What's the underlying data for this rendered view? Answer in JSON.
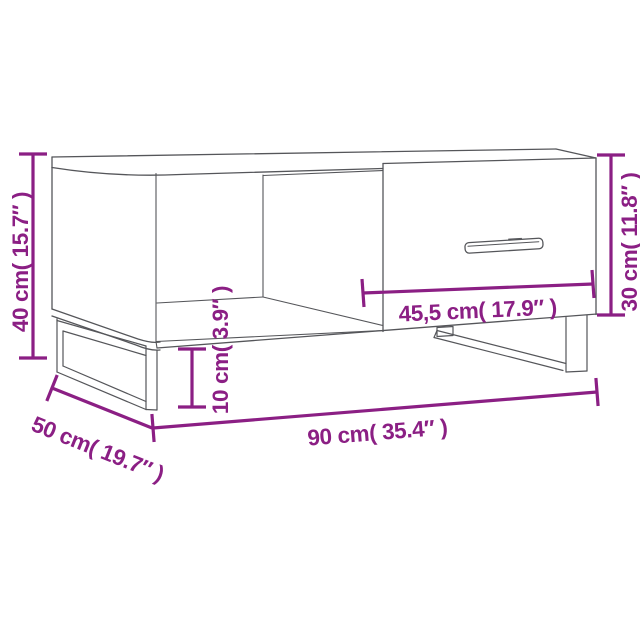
{
  "page": {
    "background": "#ffffff"
  },
  "diagram": {
    "kind": "furniture-dimension-diagram",
    "subject": "coffee table with drawer and metal legs",
    "accent_color": "#8B1F84",
    "line_color": "#55565A",
    "dimensions": {
      "height": {
        "label": "40 cm( 15.7″ )",
        "cm": "40",
        "inch": "15.7"
      },
      "depth": {
        "label": "50 cm( 19.7″ )",
        "cm": "50",
        "inch": "19.7"
      },
      "width": {
        "label": "90 cm( 35.4″ )",
        "cm": "90",
        "inch": "35.4"
      },
      "drawer_width": {
        "label": "45,5 cm( 17.9″ )",
        "cm": "45,5",
        "inch": "17.9"
      },
      "leg_clearance": {
        "label": "10 cm( 3.9″ )",
        "cm": "10",
        "inch": "3.9"
      },
      "body_height": {
        "label": "30 cm( 11.8″ )",
        "cm": "30",
        "inch": "11.8"
      }
    }
  }
}
